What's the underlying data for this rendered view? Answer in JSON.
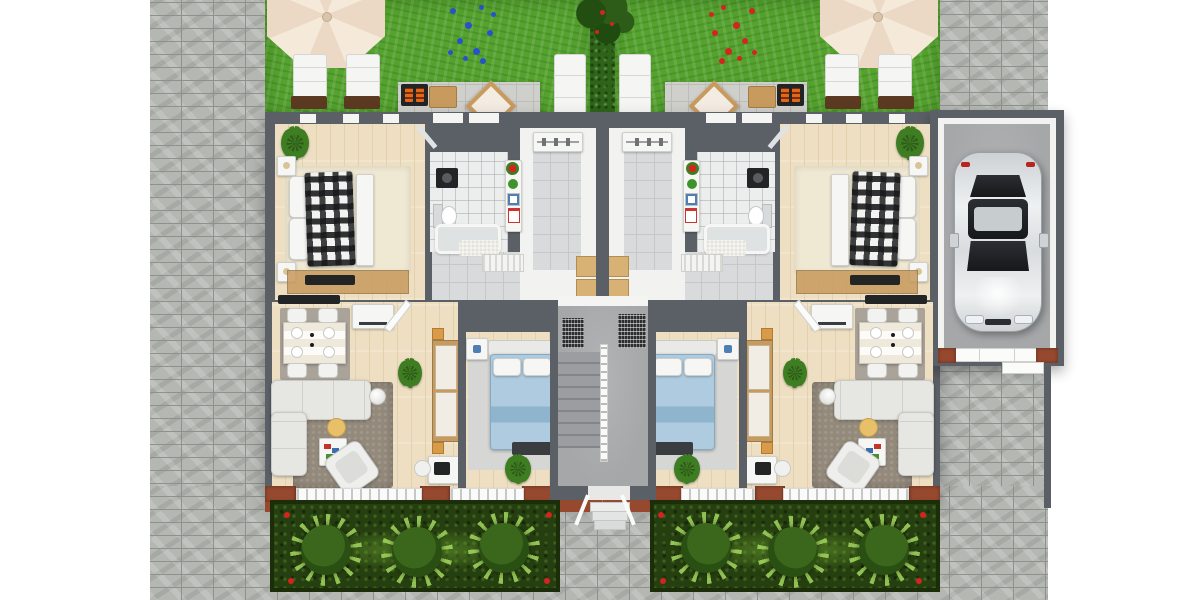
{
  "scene": {
    "title": "3D top-view floor plan — two-unit duplex ground floor with gardens and garage",
    "view": "top-down 3D architectural render",
    "visible_text": "none"
  },
  "site": {
    "left_walkway": "gray stone pavers",
    "front_plaza": "gray stone pavers along bottom",
    "rear_right_paving": "gray stone pavers beside garage",
    "hedge_divider": "dark green hedge splitting the two rear lawns, small tree and red blossoms at top",
    "front_garden_beds": 2,
    "topiary_bushes_per_bed": 3,
    "boundary_fence": "dark gray fence line below garage"
  },
  "units": [
    {
      "id": "unit-left",
      "label": "Left apartment",
      "garden": {
        "lawn": "green grass",
        "parasol": "cream octagonal umbrella",
        "sun_loungers": 3,
        "flower_patch": "blue flowers",
        "terrace": "light stone patio",
        "barbecue_grill": 1,
        "wood_side_table": 1,
        "patio_stool": 1
      },
      "rooms": [
        {
          "name": "master bedroom",
          "floor": "light wood",
          "furniture": [
            "double bed with black-white plaid blanket",
            "white pillows",
            "two nightstands with lamps",
            "foot bench",
            "cream area rug",
            "potted plant",
            "wood sideboard with TV"
          ]
        },
        {
          "name": "bathroom",
          "floor": "white tile",
          "furniture": [
            "washing machine",
            "toilet",
            "bathtub",
            "bath mat"
          ]
        },
        {
          "name": "kitchen",
          "floor": "gray tile",
          "furniture": [
            "counter shelf",
            "tomato pot",
            "herb plant",
            "utensil box",
            "recipe card",
            "slatted bench"
          ]
        },
        {
          "name": "entry hall",
          "floor": "gray tile",
          "furniture": [
            "wardrobe shelf with hangers",
            "tan double entry door"
          ]
        },
        {
          "name": "living-dining room",
          "floor": "light wood",
          "furniture": [
            "striped dining table with 4 place settings",
            "4 dining chairs",
            "gray dining rug",
            "white kitchen island",
            "dark TV sideboard",
            "L-shaped light sofa",
            "white armchair",
            "yellow side table",
            "white coffee table with books",
            "ball pendant lamp",
            "taupe shag rug",
            "potted plant",
            "open white door",
            "tall wood wardrobe",
            "desk with laptop",
            "desk chair"
          ]
        },
        {
          "name": "second bedroom",
          "floor": "light wood",
          "furniture": [
            "bed with light-blue bedding",
            "white pillows",
            "headboard",
            "nightstand with blue decor",
            "dark foot bench",
            "gray area rug",
            "potted plant"
          ]
        },
        {
          "name": "balcony edge",
          "furniture": [
            "white railings",
            "terracotta parapet piers"
          ]
        }
      ],
      "front_bed": {
        "bushes": 3,
        "accent_flowers": "red",
        "grasses": "light green spikes"
      }
    },
    {
      "id": "unit-right",
      "label": "Right apartment (mirror of left)",
      "garden": {
        "lawn": "green grass",
        "parasol": "cream octagonal umbrella",
        "sun_loungers": 3,
        "flower_patch": "red flowers",
        "terrace": "light stone patio",
        "barbecue_grill": 1,
        "wood_side_table": 1,
        "patio_stool": 1
      },
      "rooms": "mirrored copy of left apartment rooms",
      "front_bed": {
        "bushes": 3,
        "accent_flowers": "red",
        "grasses": "light green spikes"
      }
    }
  ],
  "shared": {
    "stairwell": {
      "treads": 8,
      "handrail": "white with balusters",
      "doormats": 2,
      "exterior_steps": 3
    },
    "garage": {
      "vehicle": "silver car, top view, parked facing the white garage door",
      "floor": "concrete"
    }
  },
  "palette": {
    "page-bg": "#ffffff",
    "stone-base": "#b5b7b3",
    "stone-line": "#8f918d",
    "lawn": "#55a22e",
    "hedge": "#2e6419",
    "patio": "#cfcfcb",
    "patio-line": "#bcbcb8",
    "wall": "#5b6066",
    "room-white": "#f2f3f1",
    "wood-floor": "#eedfc2",
    "wood-plank": "#e2d1ae",
    "tile": "#d8dadc",
    "tile-line": "#c5c7c9",
    "concrete": "#a5a7a9",
    "plaid-b": "#f2f2f0",
    "umbrella": "#f5e9da",
    "umbrella-shade": "#ebd9c5",
    "lounger-base": "#5c3a22",
    "grill-dark": "#222426",
    "flame": "#e06818",
    "wood-table": "#c89a5e",
    "door-tan": "#d8b275",
    "brick": "#96492f",
    "rail-white": "#fafafa",
    "sofa": "#e6e6e3",
    "taupe-rug": "#948a7c",
    "bed-blue": "#aecbdf",
    "bed-blue-dark": "#8fb4cd",
    "plant-green": "#3f7d22",
    "bush": "#3a671c",
    "bush-dark": "#2a4f12",
    "bed-soil": "#263f10",
    "bed-soil-dark": "#1b2e09",
    "grass-spike": "#a4d75f",
    "flower-blue": "#2853c8",
    "flower-red": "#d42420",
    "car-glass": "#1c1f23"
  }
}
